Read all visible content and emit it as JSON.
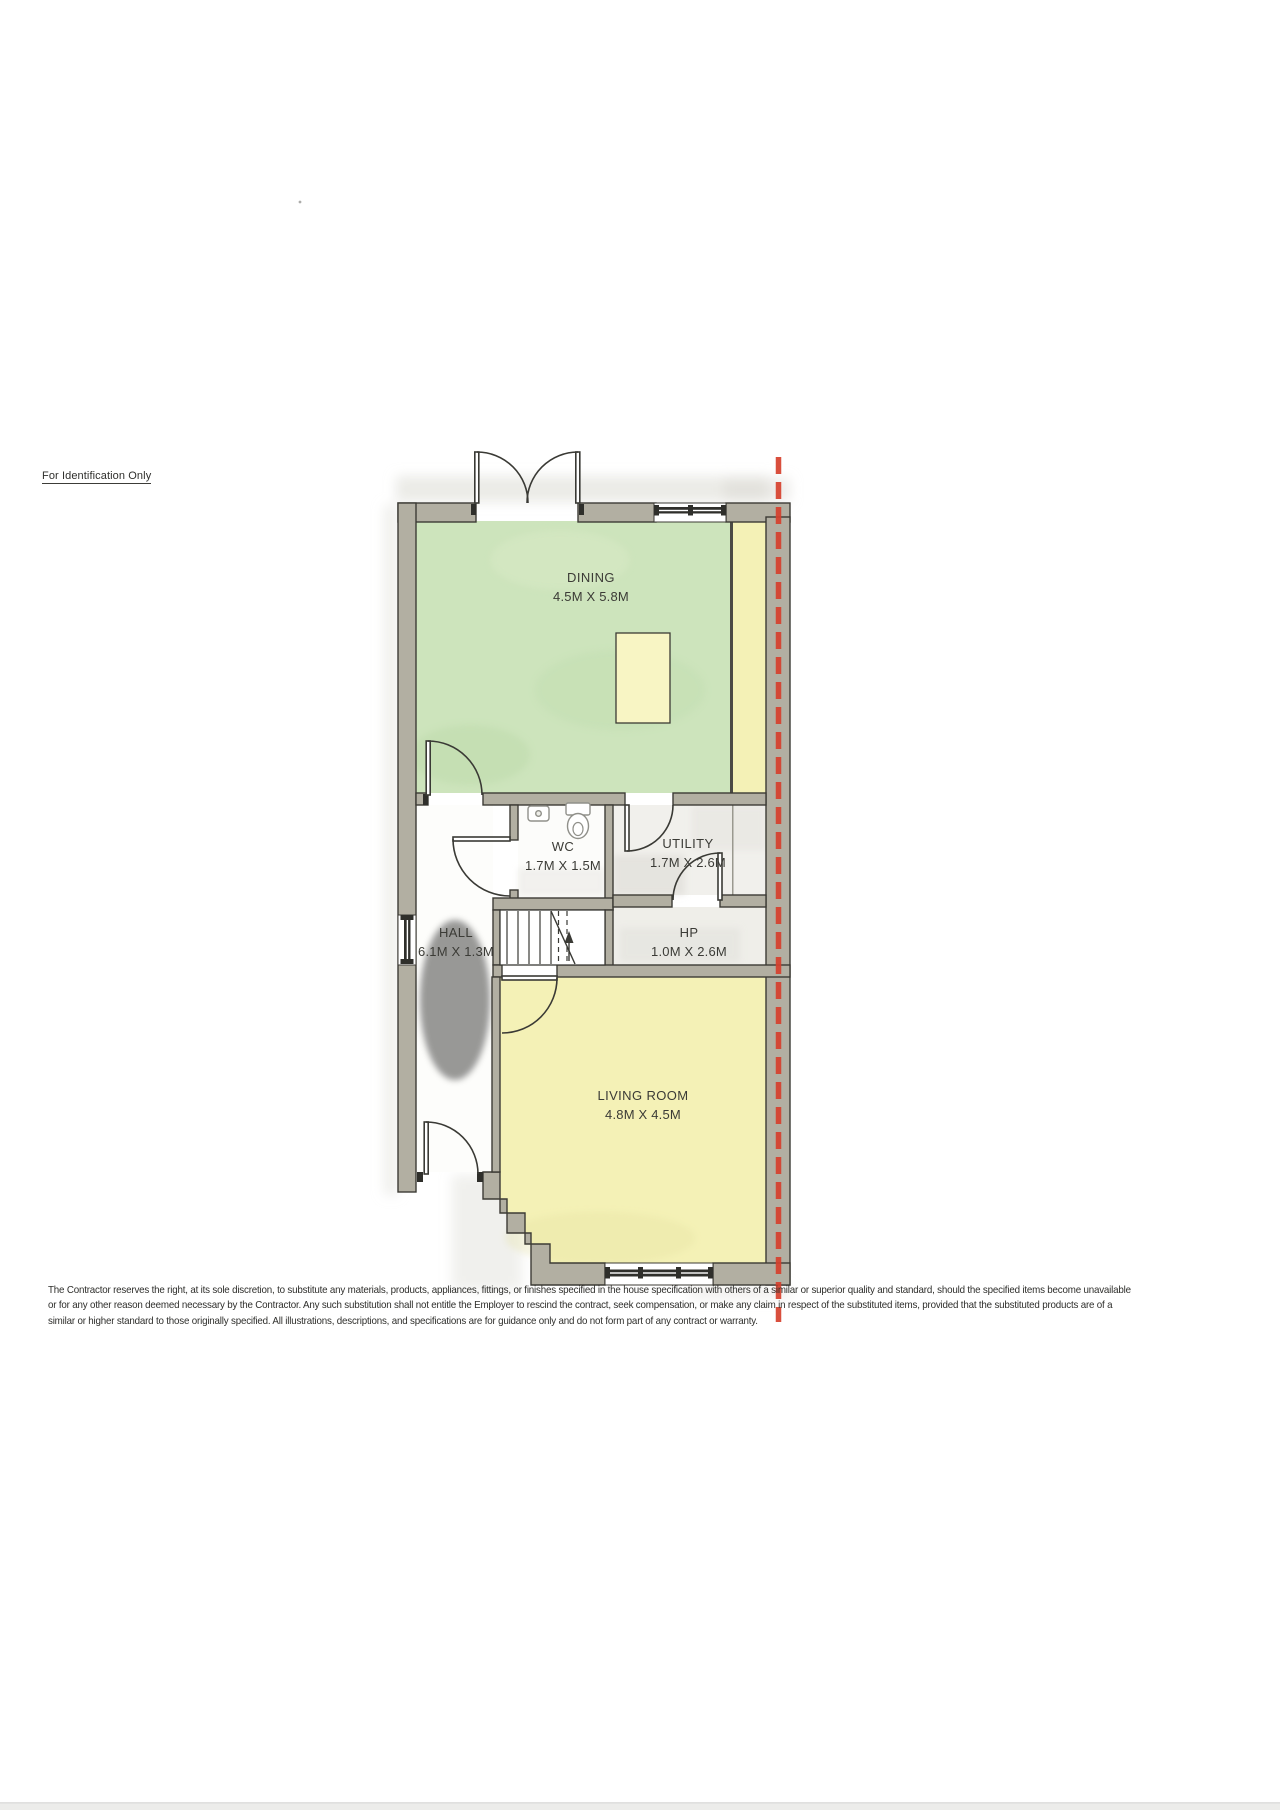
{
  "document": {
    "identification_note": "For Identification Only",
    "disclaimer_lines": [
      "The Contractor reserves the right, at its sole discretion, to substitute any materials, products, appliances, fittings, or finishes specified in the house specification with others of a similar or superior quality and standard, should the specified items become unavailable",
      "or for any other reason deemed necessary by the Contractor. Any such substitution shall not entitle the Employer to rescind the contract, seek compensation, or make any claim in respect of the substituted items, provided that the substituted products are of a",
      "similar or higher standard to those originally specified. All illustrations, descriptions, and specifications are for guidance only and do not form part of any contract or warranty."
    ]
  },
  "floor_plan": {
    "rooms": [
      {
        "name": "DINING",
        "dims": "4.5M X 5.8M"
      },
      {
        "name": "WC",
        "dims": "1.7M X 1.5M"
      },
      {
        "name": "UTILITY",
        "dims": "1.7M X 2.6M"
      },
      {
        "name": "HALL",
        "dims": "6.1M X 1.3M"
      },
      {
        "name": "HP",
        "dims": "1.0M X 2.6M"
      },
      {
        "name": "LIVING ROOM",
        "dims": "4.8M X 4.5M"
      }
    ],
    "fixtures": [
      "toilet",
      "sink",
      "stairs-up",
      "dining-table"
    ],
    "colors": {
      "wall_fill": "#b2afa2",
      "wall_line": "#3c3b35",
      "dining_floor": "#cde4bc",
      "living_floor": "#f4f1b6",
      "table_fill": "#f8f5c4",
      "boundary_line_red": "#d6402d"
    }
  }
}
